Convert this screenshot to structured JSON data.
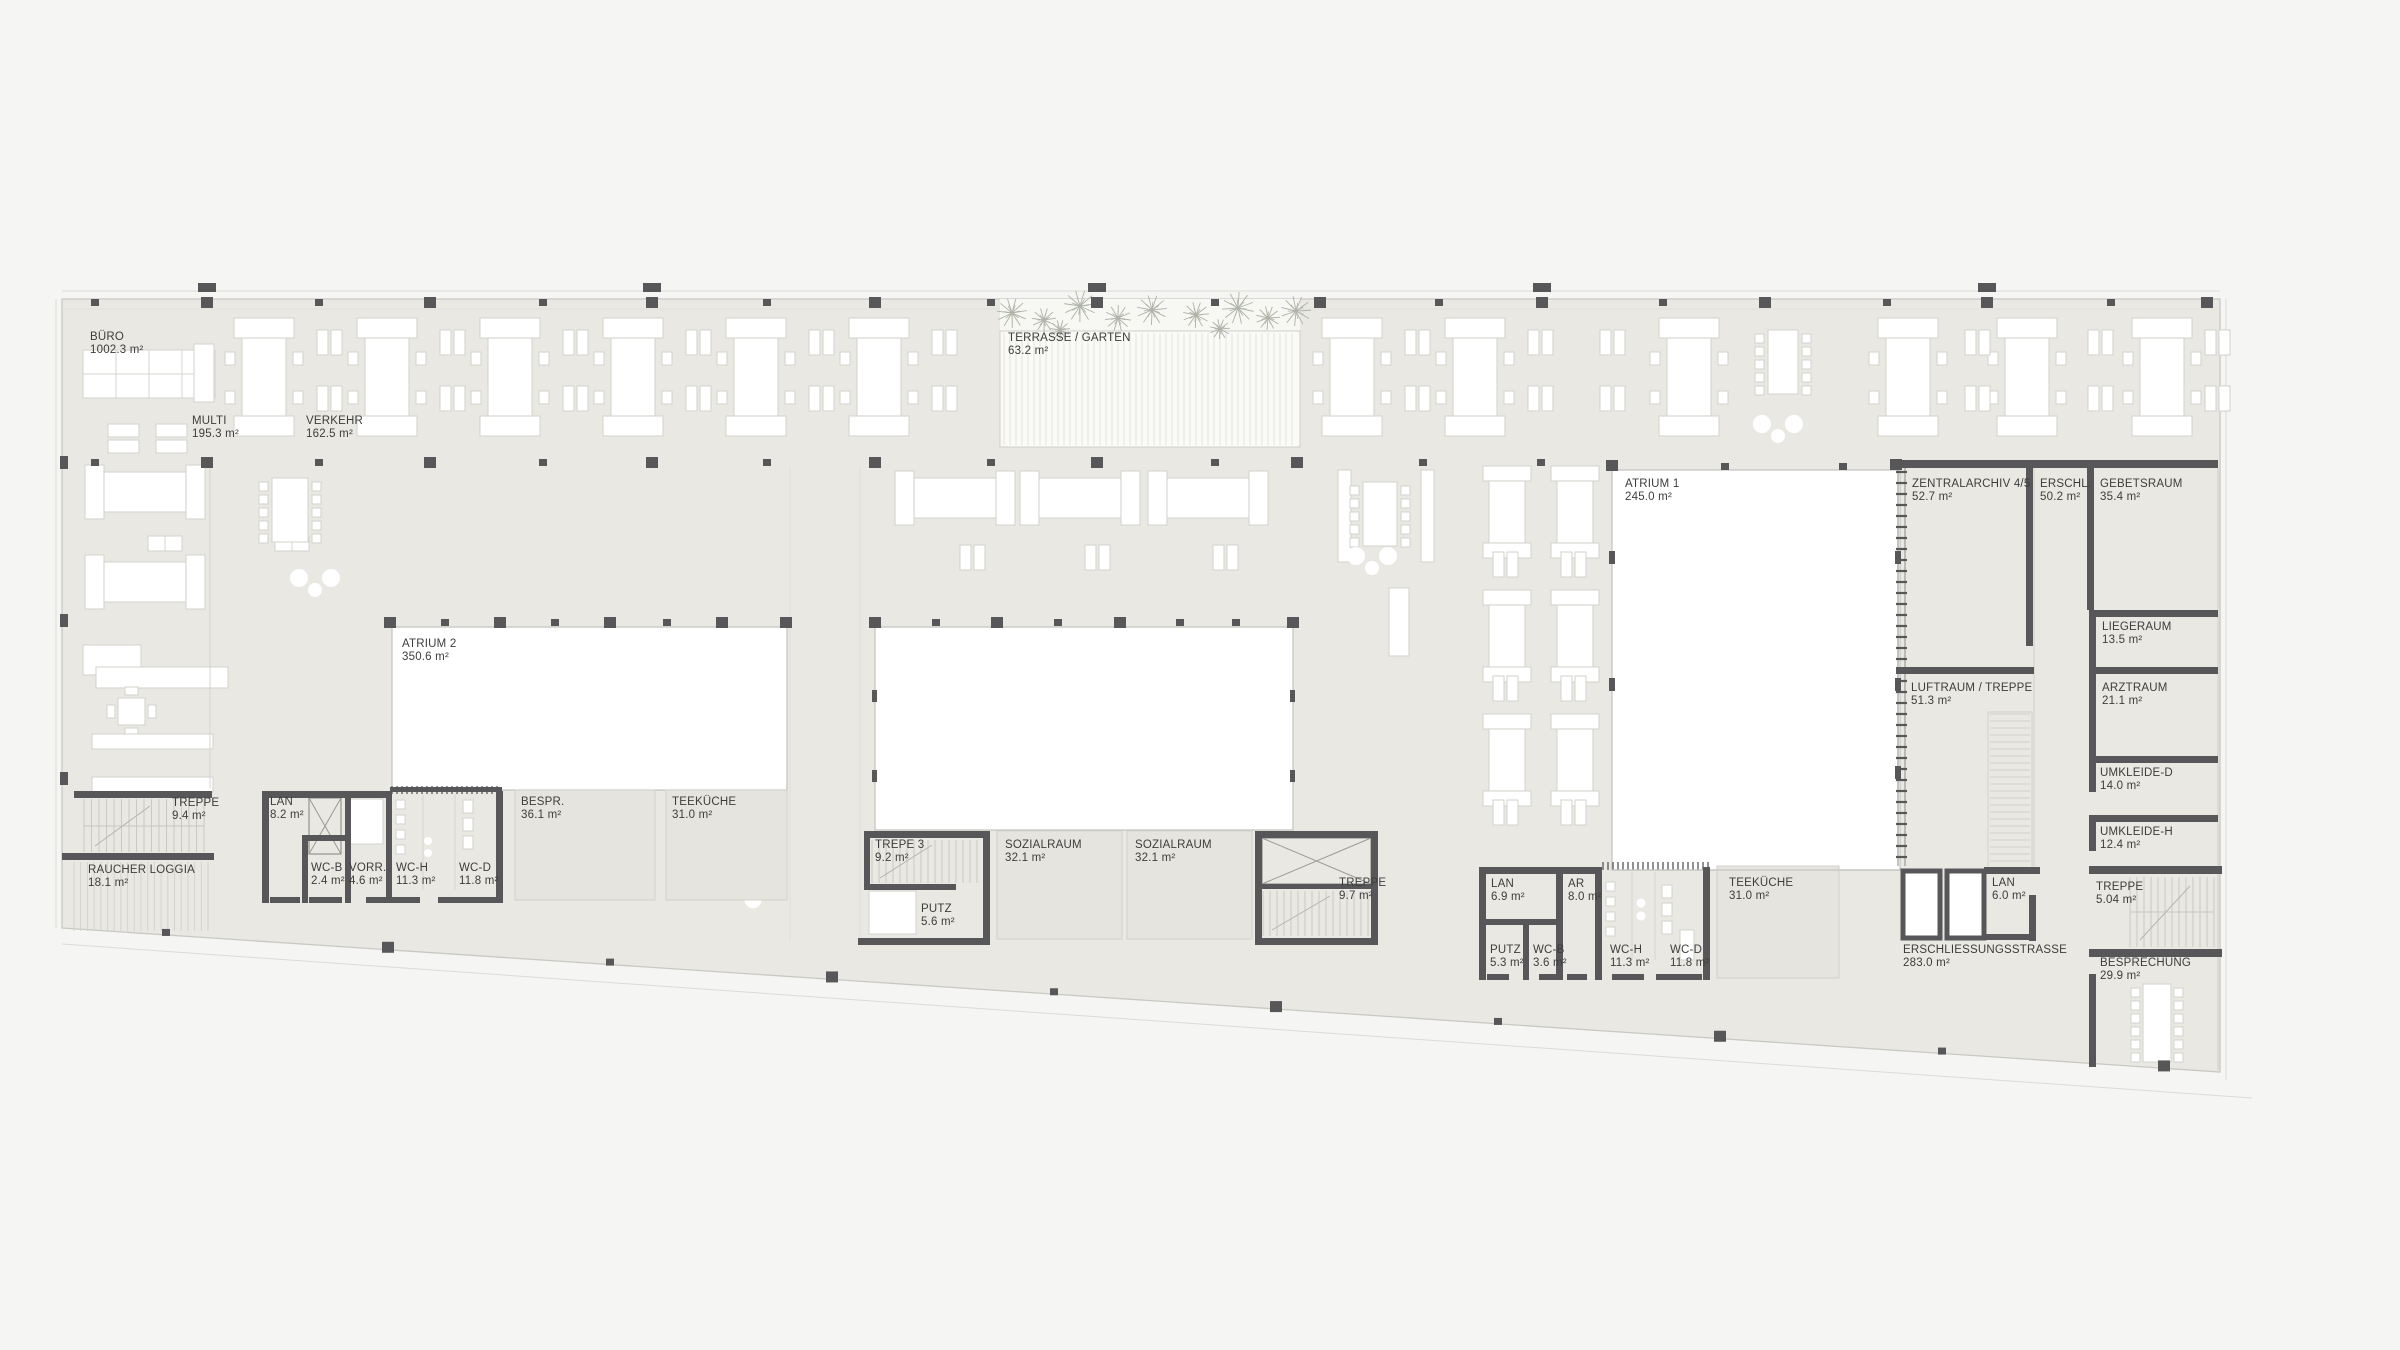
{
  "document": {
    "kind_label": "architectural floor plan"
  },
  "colors": {
    "background": "#f5f5f3",
    "floor": "#e9e8e3",
    "room_floor": "#e6e4df",
    "void_white": "#ffffff",
    "wall": "#57575a",
    "furniture_outline": "#d6d5cf",
    "thin_line": "#c9c8c2",
    "hatch": "#d8d7d1",
    "vegetation": "#aeb2a7",
    "label_text": "#3d3d3c"
  },
  "rooms": {
    "buero": {
      "name": "BÜRO",
      "area": "1002.3 m²"
    },
    "multi": {
      "name": "MULTI",
      "area": "195.3 m²"
    },
    "verkehr": {
      "name": "VERKEHR",
      "area": "162.5 m²"
    },
    "terrasse": {
      "name": "TERRASSE / GARTEN",
      "area": "63.2 m²"
    },
    "atrium2": {
      "name": "ATRIUM 2",
      "area": "350.6 m²"
    },
    "atrium1": {
      "name": "ATRIUM 1",
      "area": "245.0 m²"
    },
    "zentralarchiv": {
      "name": "ZENTRALARCHIV 4/5",
      "area": "52.7 m²"
    },
    "erschl": {
      "name": "ERSCHL.",
      "area": "50.2 m²"
    },
    "gebetsraum": {
      "name": "GEBETSRAUM",
      "area": "35.4 m²"
    },
    "liegeraum": {
      "name": "LIEGERAUM",
      "area": "13.5 m²"
    },
    "arztraum": {
      "name": "ARZTRAUM",
      "area": "21.1 m²"
    },
    "umkleide_d": {
      "name": "UMKLEIDE-D",
      "area": "14.0 m²"
    },
    "umkleide_h": {
      "name": "UMKLEIDE-H",
      "area": "12.4 m²"
    },
    "treppe_r": {
      "name": "TREPPE",
      "area": "5.04 m²"
    },
    "besprechung": {
      "name": "BESPRECHUNG",
      "area": "29.9 m²"
    },
    "luftraum": {
      "name": "LUFTRAUM / TREPPE",
      "area": "51.3 m²"
    },
    "treppe_l": {
      "name": "TREPPE",
      "area": "9.4 m²"
    },
    "raucher": {
      "name": "RAUCHER LOGGIA",
      "area": "18.1 m²"
    },
    "lan_l": {
      "name": "LAN",
      "area": "8.2 m²"
    },
    "wcb_l": {
      "name": "WC-B",
      "area": "2.4 m²"
    },
    "vorr": {
      "name": "VORR.",
      "area": "4.6 m²"
    },
    "wch_l": {
      "name": "WC-H",
      "area": "11.3 m²"
    },
    "wcd_l": {
      "name": "WC-D",
      "area": "11.8 m²"
    },
    "bespr": {
      "name": "BESPR.",
      "area": "36.1 m²"
    },
    "teekueche_l": {
      "name": "TEEKÜCHE",
      "area": "31.0 m²"
    },
    "trepe3": {
      "name": "TREPE 3",
      "area": "9.2 m²"
    },
    "putz_m": {
      "name": "PUTZ",
      "area": "5.6 m²"
    },
    "sozialraum1": {
      "name": "SOZIALRAUM",
      "area": "32.1 m²"
    },
    "sozialraum2": {
      "name": "SOZIALRAUM",
      "area": "32.1 m²"
    },
    "treppe_m": {
      "name": "TREPPE",
      "area": "9.7 m²"
    },
    "lan_c": {
      "name": "LAN",
      "area": "6.9 m²"
    },
    "ar": {
      "name": "AR",
      "area": "8.0 m²"
    },
    "teekueche_r": {
      "name": "TEEKÜCHE",
      "area": "31.0 m²"
    },
    "putz_r": {
      "name": "PUTZ",
      "area": "5.3 m²"
    },
    "wcb_r": {
      "name": "WC-B",
      "area": "3.6 m²"
    },
    "wch_r": {
      "name": "WC-H",
      "area": "11.3 m²"
    },
    "wcd_r": {
      "name": "WC-D",
      "area": "11.8 m²"
    },
    "erschliessungsstrasse": {
      "name": "ERSCHLIESSUNGSSTRASSE",
      "area": "283.0 m²"
    },
    "lan_r": {
      "name": "LAN",
      "area": "6.0 m²"
    }
  }
}
